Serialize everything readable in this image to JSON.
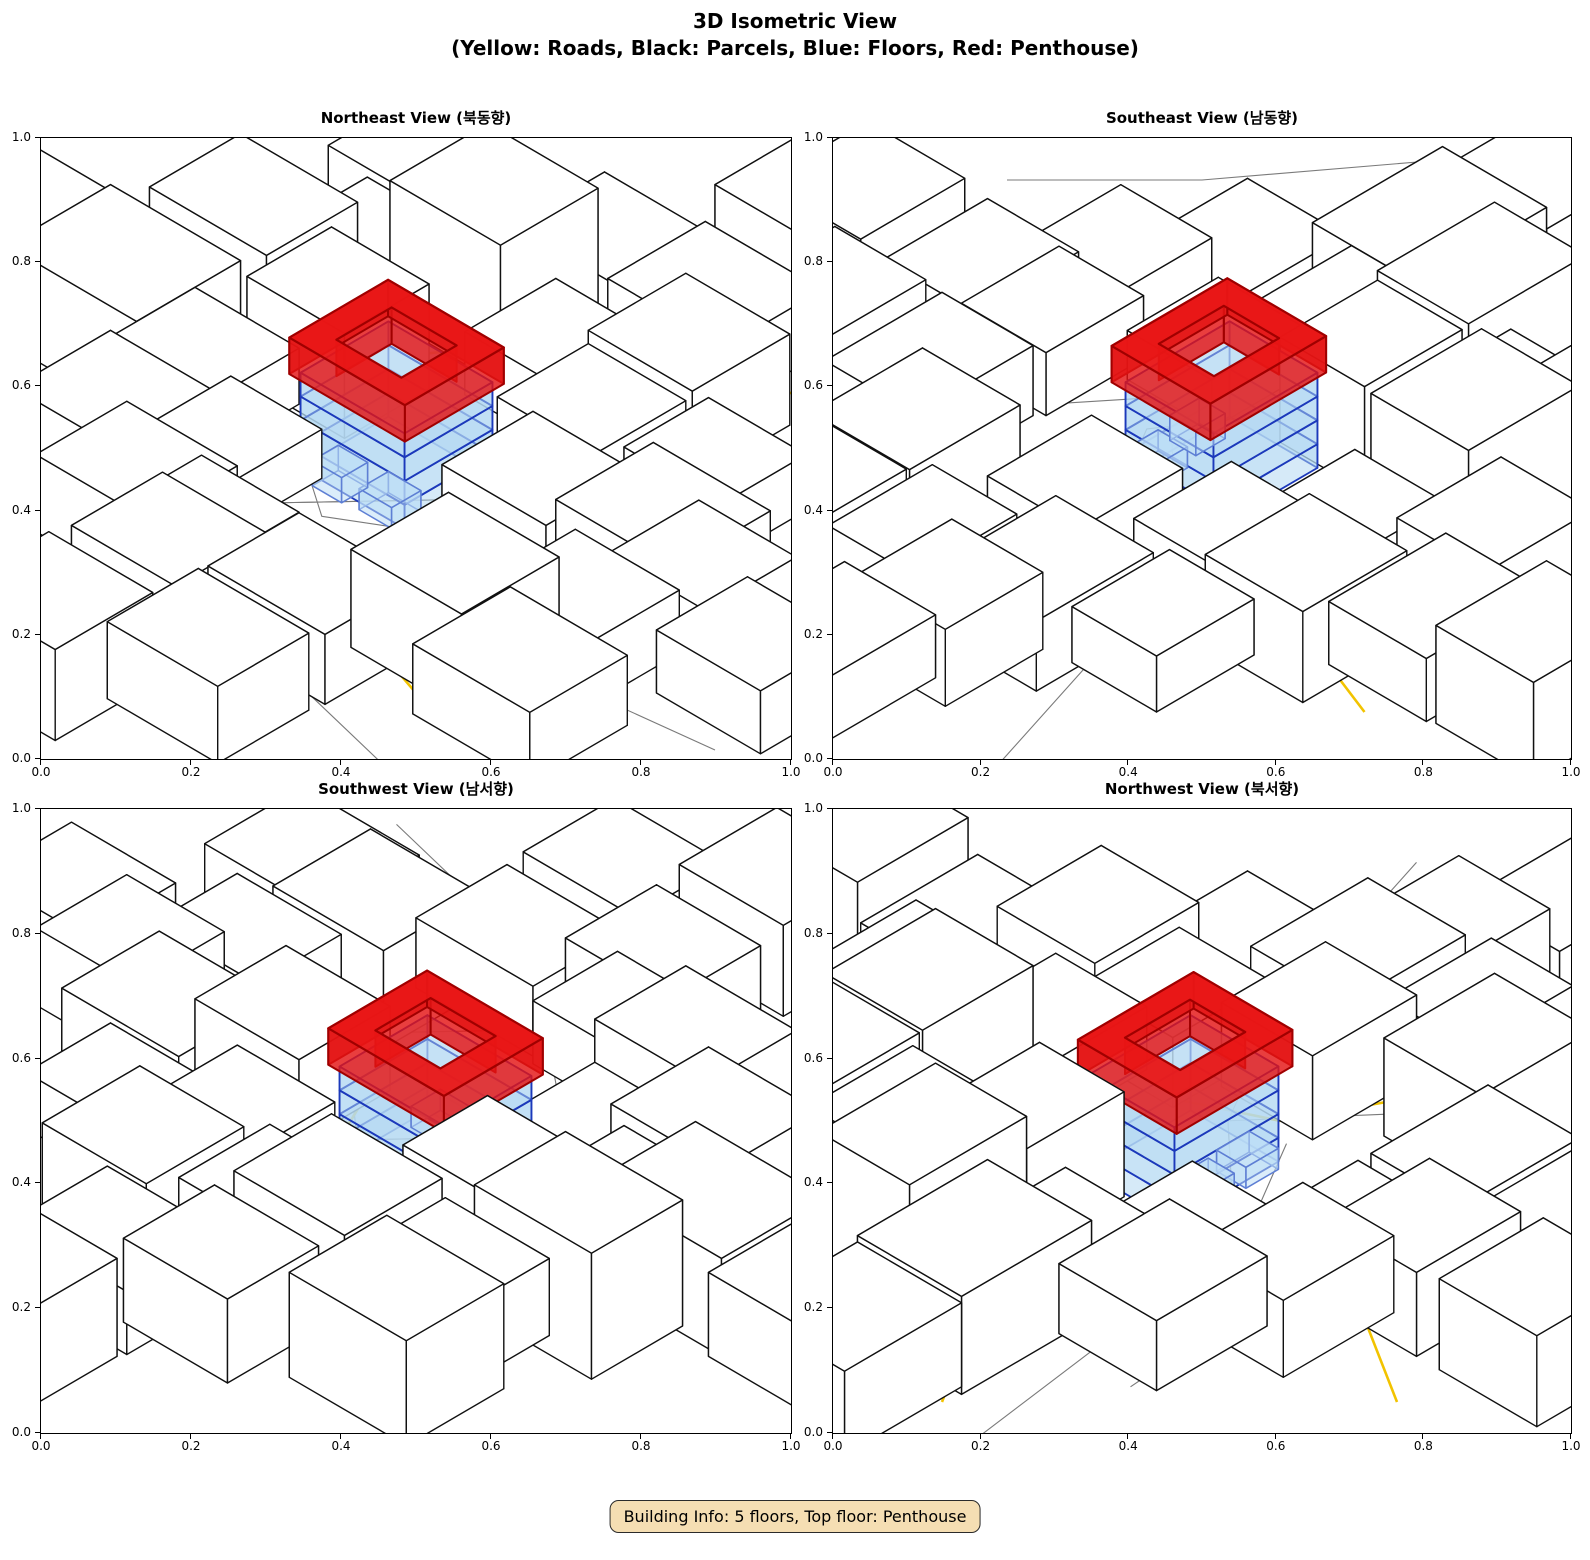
{
  "title": {
    "line1": "3D Isometric View",
    "line2": "(Yellow: Roads, Black: Parcels, Blue: Floors, Red: Penthouse)"
  },
  "info_box": "Building Info: 5 floors, Top floor: Penthouse",
  "axes": {
    "ticks": [
      "0.0",
      "0.2",
      "0.4",
      "0.6",
      "0.8",
      "1.0"
    ],
    "range": [
      0.0,
      1.0
    ]
  },
  "colors": {
    "road": "#f2c300",
    "parcel_line": "#7a7a7a",
    "block_fill": "#ffffff",
    "block_edge": "#111111",
    "floor_fill": "rgba(174,214,241,0.50)",
    "floor_top_fill": "rgba(190,222,245,0.45)",
    "floor_edge": "#1c39bb",
    "sub_box_edge": "#5e7fd4",
    "sub_box_fill": "rgba(190,222,245,0.55)",
    "penthouse_wall_fill": "rgba(228,20,20,0.82)",
    "penthouse_top_fill": "rgba(233,21,21,0.95)",
    "penthouse_edge": "#a00000",
    "info_bg": "#f5deb3",
    "info_border": "#2b2b2b"
  },
  "chart_data": {
    "type": "3d-isometric-city-views",
    "title": "3D Isometric View",
    "subtitle": "(Yellow: Roads, Black: Parcels, Blue: Floors, Red: Penthouse)",
    "legend": {
      "yellow": "Roads",
      "black": "Parcels",
      "blue": "Floors",
      "red": "Penthouse"
    },
    "building": {
      "floors": 5,
      "top_floor": "Penthouse",
      "blue_floors": 4
    },
    "axis_ticks": [
      0.0,
      0.2,
      0.4,
      0.6,
      0.8,
      1.0
    ],
    "views": [
      {
        "key": "northeast",
        "label": "Northeast View (북동향)",
        "azimuth": 0
      },
      {
        "key": "southeast",
        "label": "Southeast View (남동향)",
        "azimuth": 90
      },
      {
        "key": "southwest",
        "label": "Southwest View (남서향)",
        "azimuth": 180
      },
      {
        "key": "northwest",
        "label": "Northwest View (북서향)",
        "azimuth": 270
      }
    ],
    "projection": {
      "kx": 65,
      "ky": 38,
      "kz": 70,
      "cy": 346
    },
    "scene": {
      "main": {
        "x": -0.3,
        "y": 0.0,
        "w": 1.6,
        "d": 1.35,
        "floor_h": 0.34,
        "floors": 4,
        "sub_boxes": [
          [
            0.15,
            0.55,
            0.5,
            0.45,
            0.3
          ],
          [
            -0.55,
            0.62,
            0.45,
            0.4,
            0.36
          ]
        ],
        "penthouse": {
          "x": -0.28,
          "y": 0.02,
          "ow": 1.78,
          "od": 1.52,
          "iw": 1.0,
          "id": 0.85,
          "h": 0.52
        }
      },
      "blocks": [
        [
          -4.0,
          0.5,
          2.0,
          1.6,
          1.4
        ],
        [
          -3.4,
          -0.9,
          1.8,
          1.4,
          1.8
        ],
        [
          -2.6,
          -2.0,
          1.6,
          1.3,
          1.1
        ],
        [
          -1.5,
          -2.7,
          1.7,
          1.5,
          2.0
        ],
        [
          -0.75,
          -3.75,
          1.6,
          1.4,
          1.2
        ],
        [
          0.5,
          -4.1,
          1.8,
          1.5,
          0.9
        ],
        [
          -2.75,
          0.55,
          1.6,
          1.4,
          0.8
        ],
        [
          -1.9,
          -0.7,
          1.5,
          1.3,
          1.5
        ],
        [
          -0.05,
          -2.25,
          1.5,
          1.4,
          0.9
        ],
        [
          1.3,
          -2.9,
          1.6,
          1.5,
          1.3
        ],
        [
          -2.6,
          2.0,
          1.7,
          1.5,
          1.0
        ],
        [
          -1.5,
          1.3,
          1.4,
          1.3,
          0.7
        ],
        [
          1.15,
          -1.55,
          1.5,
          1.4,
          1.0
        ],
        [
          2.6,
          -2.0,
          1.5,
          1.3,
          0.8
        ],
        [
          -1.45,
          2.85,
          1.7,
          1.4,
          1.1
        ],
        [
          -0.45,
          2.75,
          1.5,
          1.3,
          0.9
        ],
        [
          1.85,
          -0.05,
          1.6,
          1.4,
          1.2
        ],
        [
          3.1,
          -0.7,
          1.8,
          1.5,
          1.0
        ],
        [
          -0.2,
          3.6,
          1.6,
          1.4,
          1.2
        ],
        [
          1.3,
          2.9,
          1.8,
          1.4,
          1.0
        ],
        [
          2.5,
          1.9,
          1.7,
          1.5,
          1.4
        ],
        [
          3.45,
          0.85,
          1.6,
          1.3,
          0.9
        ],
        [
          4.15,
          -0.25,
          1.5,
          1.4,
          1.1
        ],
        [
          -2.85,
          -3.15,
          1.8,
          1.5,
          1.5
        ],
        [
          1.3,
          4.5,
          1.7,
          1.4,
          1.1
        ],
        [
          3.9,
          2.3,
          1.8,
          1.5,
          1.0
        ],
        [
          5.4,
          0.2,
          1.6,
          1.4,
          0.9
        ],
        [
          -0.2,
          5.4,
          1.6,
          1.5,
          1.3
        ],
        [
          -5.8,
          0.4,
          1.8,
          1.6,
          1.2
        ],
        [
          0.5,
          -5.7,
          1.7,
          1.5,
          1.4
        ]
      ],
      "roads": [
        [
          [
            1.75,
            -4.25
          ],
          [
            0.5,
            -1.0
          ],
          [
            1.05,
            0.15
          ],
          [
            4.5,
            2.0
          ]
        ],
        [
          [
            -5.25,
            1.25
          ],
          [
            -2.5,
            -0.5
          ],
          [
            -0.9,
            -2.9
          ],
          [
            0.75,
            -5.75
          ]
        ],
        [
          [
            -1.75,
            4.75
          ],
          [
            -0.4,
            2.6
          ],
          [
            1.25,
            2.25
          ],
          [
            3.5,
            3.0
          ]
        ]
      ],
      "parcels": [
        [
          [
            -0.9,
            1.4
          ],
          [
            0.65,
            -0.25
          ],
          [
            2.15,
            1.05
          ],
          [
            0.65,
            2.65
          ],
          [
            -0.9,
            1.4
          ]
        ],
        [
          [
            -5.5,
            2.0
          ],
          [
            -0.9,
            1.4
          ],
          [
            0.65,
            -0.25
          ],
          [
            2.3,
            -1.2
          ],
          [
            5.5,
            -2.2
          ]
        ],
        [
          [
            0.65,
            2.65
          ],
          [
            2.0,
            3.6
          ],
          [
            4.5,
            4.2
          ]
        ],
        [
          [
            2.15,
            1.05
          ],
          [
            3.4,
            1.5
          ],
          [
            5.8,
            1.2
          ]
        ],
        [
          [
            -1.1,
            0.6
          ],
          [
            -0.3,
            1.15
          ],
          [
            0.8,
            0.5
          ]
        ],
        [
          [
            -0.9,
            1.4
          ],
          [
            -2.2,
            2.4
          ],
          [
            -3.6,
            2.5
          ]
        ],
        [
          [
            -6.0,
            2.5
          ],
          [
            -4.0,
            4.0
          ],
          [
            -2.5,
            5.5
          ]
        ]
      ]
    }
  }
}
